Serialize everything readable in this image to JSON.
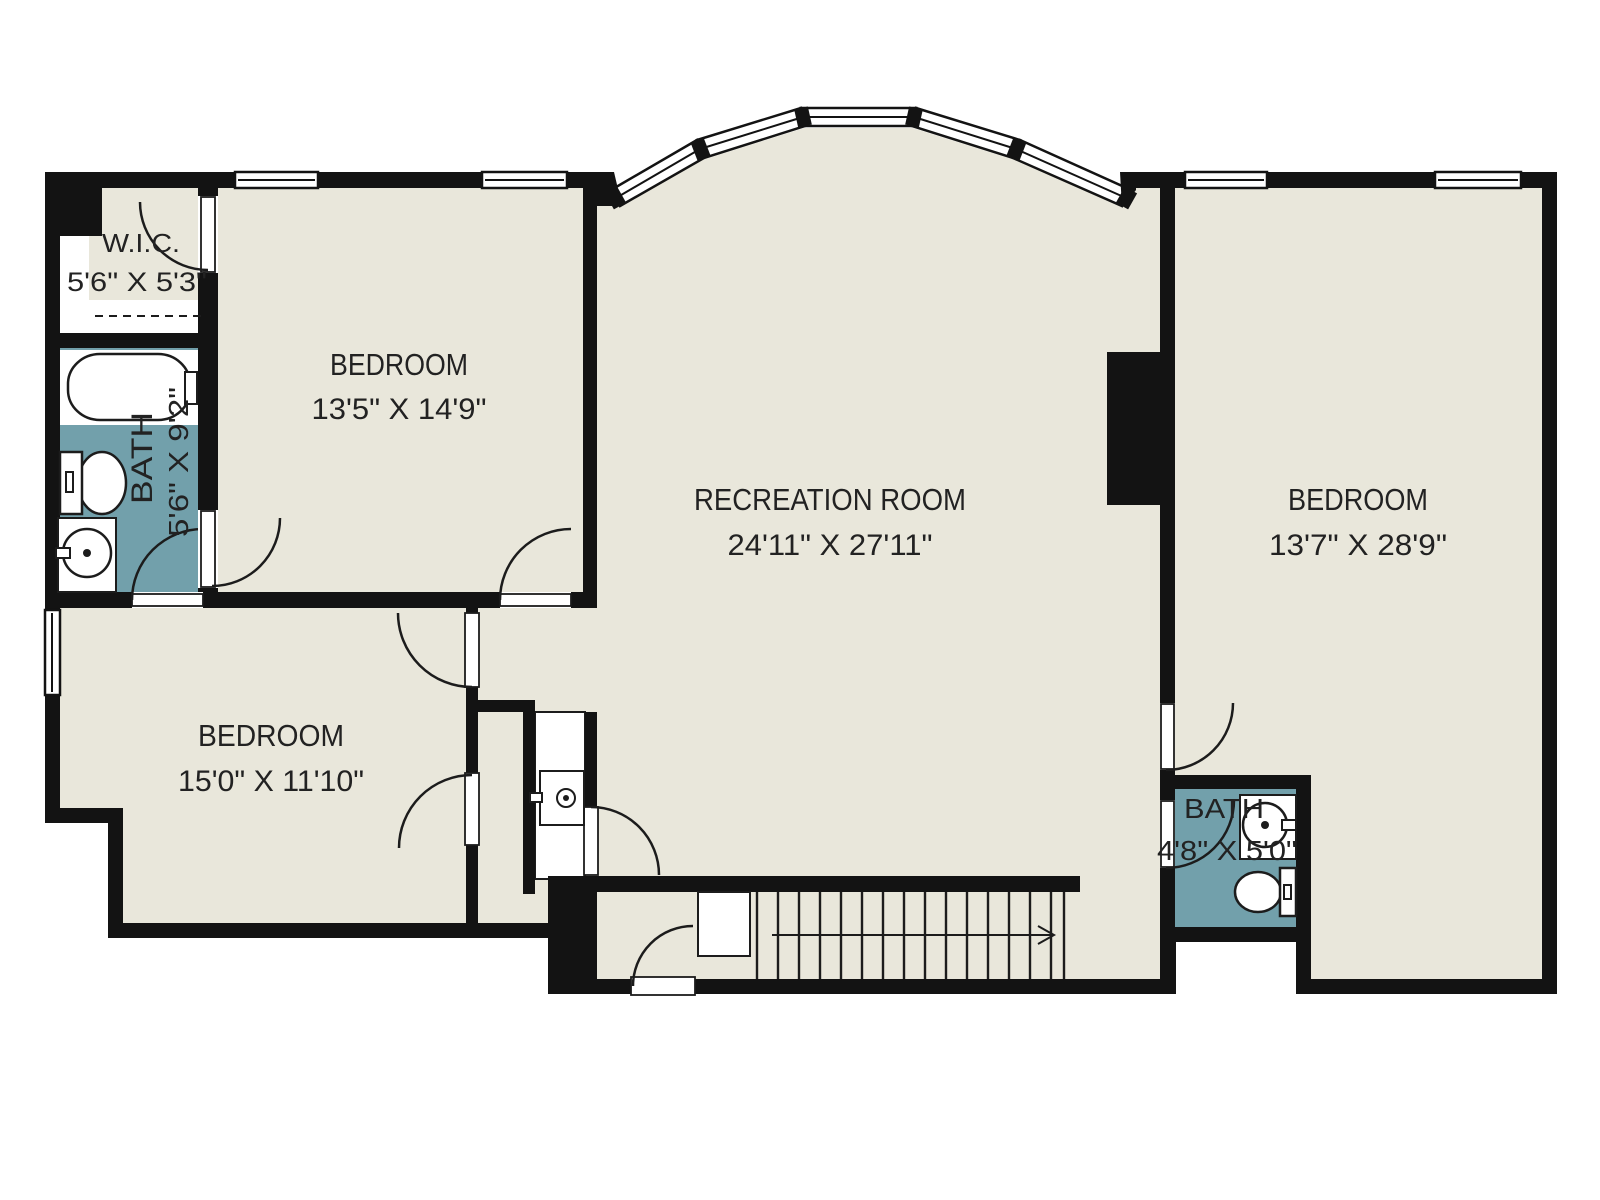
{
  "plan": {
    "rooms": [
      {
        "id": "wic",
        "name": "W.I.C.",
        "dims": "5'6\" X 5'3\""
      },
      {
        "id": "bath-left",
        "name": "BATH",
        "dims": "5'6\" X 9'2\""
      },
      {
        "id": "bedroom-upper-left",
        "name": "BEDROOM",
        "dims": "13'5\" X 14'9\""
      },
      {
        "id": "recreation-room",
        "name": "RECREATION ROOM",
        "dims": "24'11\" X 27'11\""
      },
      {
        "id": "bedroom-right",
        "name": "BEDROOM",
        "dims": "13'7\" X 28'9\""
      },
      {
        "id": "bedroom-lower-left",
        "name": "BEDROOM",
        "dims": "15'0\" X 11'10\""
      },
      {
        "id": "bath-right",
        "name": "BATH",
        "dims": "4'8\" X 5'0\""
      }
    ],
    "fixtures": [
      "bathtub-icon",
      "toilet-icon",
      "pedestal-sink-icon",
      "vanity-sink-icon",
      "closet-rod-icon",
      "stairs-icon",
      "stair-direction-arrow-icon",
      "fireplace-block",
      "bay-window",
      "window",
      "door-swing"
    ],
    "colors": {
      "floor": "#e9e7db",
      "wall": "#131313",
      "bath_floor": "#72a0ab",
      "line": "#1c1c1c",
      "outside": "#ffffff"
    }
  }
}
